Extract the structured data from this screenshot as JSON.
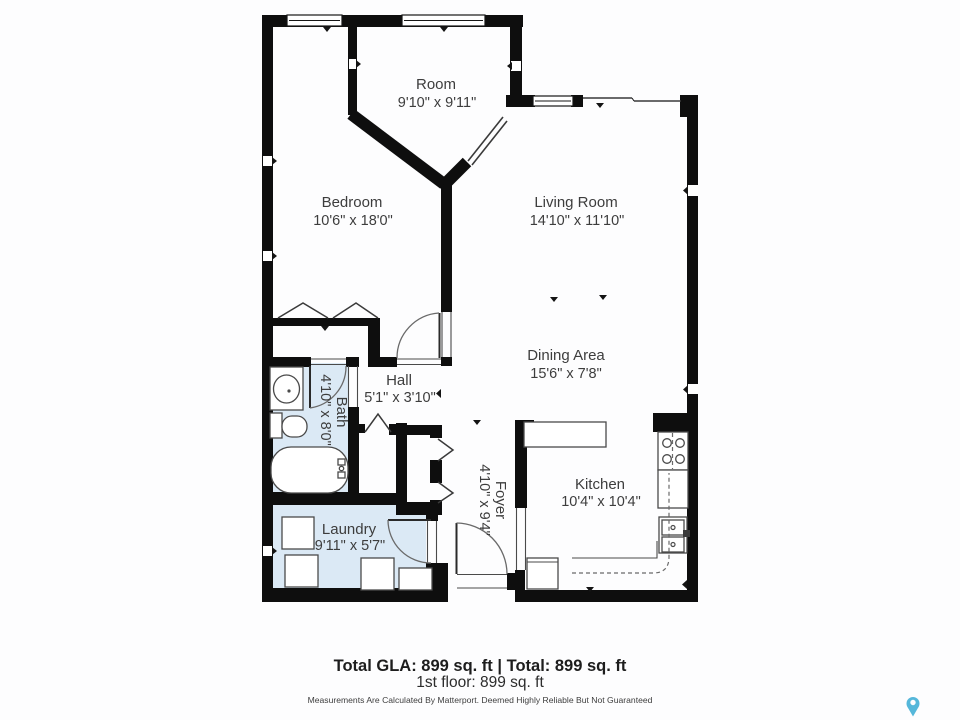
{
  "floorplan": {
    "rooms": {
      "room": {
        "name": "Room",
        "dims": "9'10\" x 9'11\""
      },
      "bedroom": {
        "name": "Bedroom",
        "dims": "10'6\" x 18'0\""
      },
      "living_room": {
        "name": "Living Room",
        "dims": "14'10\" x 11'10\""
      },
      "dining_area": {
        "name": "Dining Area",
        "dims": "15'6\" x 7'8\""
      },
      "hall": {
        "name": "Hall",
        "dims": "5'1\" x 3'10\""
      },
      "bath": {
        "name": "Bath",
        "dims": "4'10\" x 8'0\""
      },
      "foyer": {
        "name": "Foyer",
        "dims": "4'10\" x 9'4\""
      },
      "laundry": {
        "name": "Laundry",
        "dims": "9'11\" x 5'7\""
      },
      "kitchen": {
        "name": "Kitchen",
        "dims": "10'4\" x 10'4\""
      }
    },
    "footer": {
      "totals": "Total GLA: 899 sq. ft | Total: 899 sq. ft",
      "floor": "1st floor: 899 sq. ft",
      "disclaimer": "Measurements Are Calculated By Matterport. Deemed Highly Reliable But Not Guaranteed"
    },
    "colors": {
      "wall": "#0e0e0e",
      "wet_room_fill": "#dbe9f5",
      "pin": "#55b7da"
    }
  }
}
